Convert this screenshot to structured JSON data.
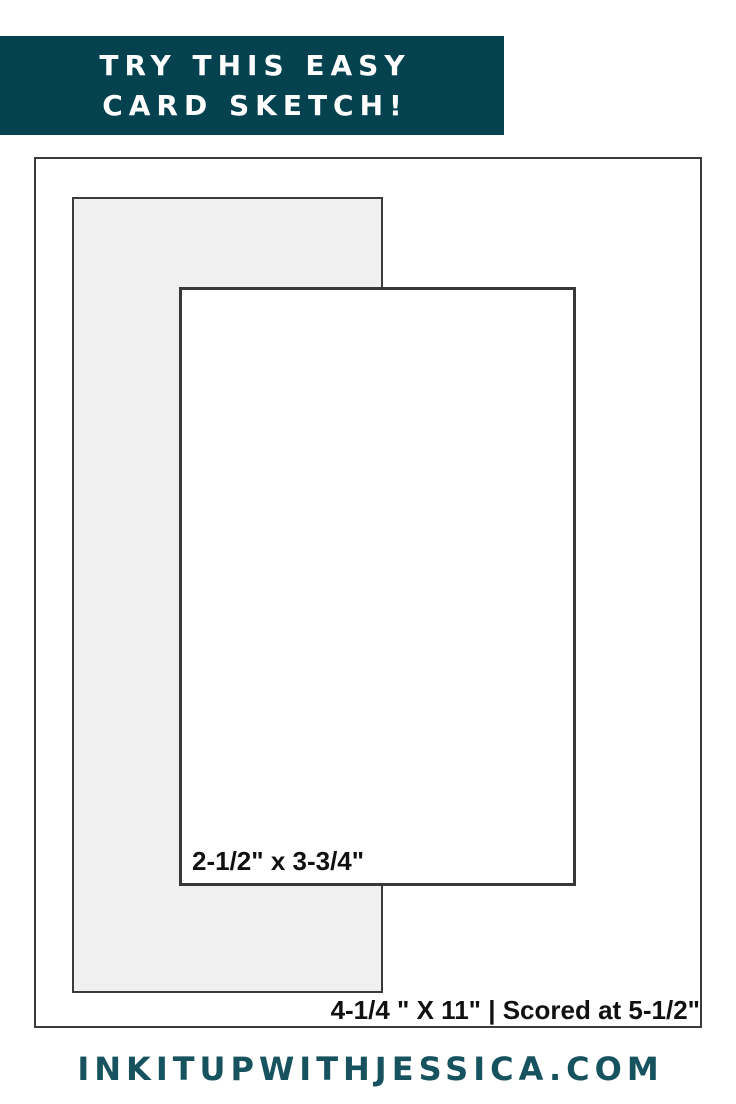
{
  "banner": {
    "line1": "TRY THIS EASY",
    "line2": "CARD SKETCH!",
    "background_color": "#05424F",
    "text_color": "#FFFFFF"
  },
  "diagram": {
    "front_panel_label": "2-1/2\" x 3-3/4\"",
    "card_base_label": "4-1/4 \" X 11\" | Scored at 5-1/2\"",
    "border_color": "#3A3A3A",
    "panel_fill_color": "#F0F0F1",
    "label_color": "#111111"
  },
  "footer": {
    "website": "INKITUPWITHJESSICA.COM",
    "text_color": "#17525F"
  }
}
